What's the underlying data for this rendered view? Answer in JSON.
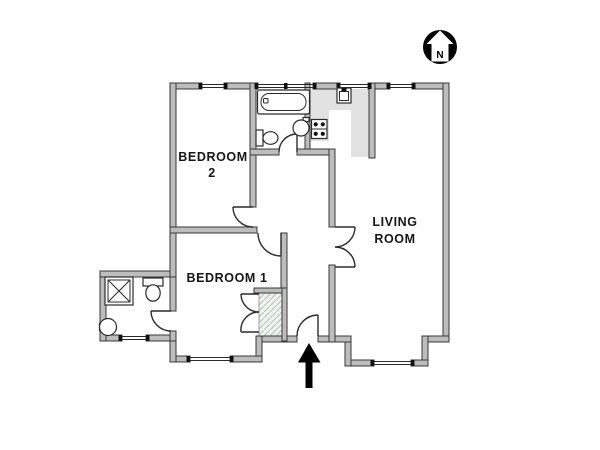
{
  "canvas": {
    "width": 600,
    "height": 450,
    "background": "#ffffff"
  },
  "compass": {
    "label": "N"
  },
  "rooms": {
    "bedroom2": {
      "line1": "BEDROOM",
      "line2": "2"
    },
    "bedroom1": {
      "label": "BEDROOM 1"
    },
    "living_room": {
      "line1": "LIVING",
      "line2": "ROOM"
    }
  },
  "icons": {
    "compass": "north-arrow-icon",
    "entrance": "entrance-arrow-icon"
  },
  "fixtures": [
    "bathtub",
    "toilet",
    "washbasin",
    "kitchen-sink",
    "stove",
    "shower",
    "closet",
    "counter"
  ],
  "colors": {
    "wall_fill": "#bdbdbd",
    "wall_stroke": "#383838",
    "line": "#2b2b2b",
    "counter": "#e2e2e2",
    "closet_hatch_line": "#b9cdb9",
    "closet_hatch_bg": "#f0f4f0",
    "accent_black": "#000000"
  }
}
